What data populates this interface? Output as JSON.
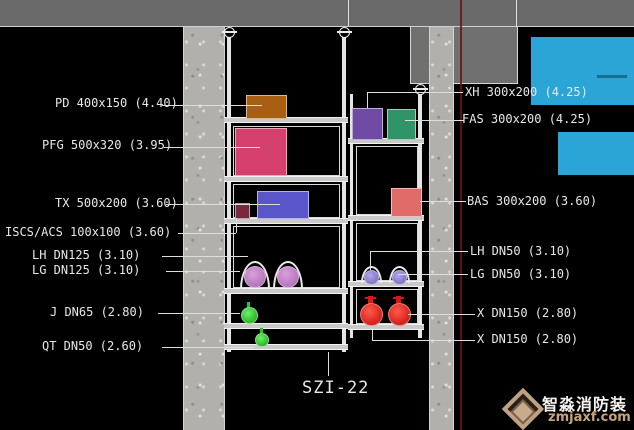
{
  "section_label": "SZI-22",
  "labels_left": [
    {
      "text": "PD 400x150 (4.40)"
    },
    {
      "text": "PFG 500x320 (3.95)"
    },
    {
      "text": "TX 500x200 (3.60)"
    },
    {
      "text": "ISCS/ACS 100x100 (3.60)"
    },
    {
      "text": "LH DN125 (3.10)"
    },
    {
      "text": "LG DN125 (3.10)"
    },
    {
      "text": "J DN65 (2.80)"
    },
    {
      "text": "QT DN50 (2.60)"
    }
  ],
  "labels_right": [
    {
      "text": "XH 300x200 (4.25)"
    },
    {
      "text": "FAS 300x200 (4.25)"
    },
    {
      "text": "BAS 300x200 (3.60)"
    },
    {
      "text": "LH DN50 (3.10)"
    },
    {
      "text": "LG DN50 (3.10)"
    },
    {
      "text": "X DN150 (2.80)"
    },
    {
      "text": "X DN150 (2.80)"
    }
  ],
  "watermark": {
    "brand": "智淼消防装",
    "url": "zmjaxf.com"
  },
  "colors": {
    "background": "#000000",
    "concrete_slab": "#6a6a6a",
    "concrete_wall": "#b2b0ad",
    "duct_pd_orange": "#a95f12",
    "duct_pfg_pink": "#d5406e",
    "duct_tx_blue": "#5a55c8",
    "duct_iscs_maroon": "#79293c",
    "duct_xh_purple": "#6f4aa2",
    "duct_fas_green": "#2f9468",
    "duct_bas_salmon": "#e06c69",
    "pipe_dn125_pink": "#bd7ec4",
    "pipe_dn50_purple": "#8d7fd2",
    "pipe_green": "#1ecb1e",
    "pipe_red": "#e11414",
    "highlight_cyan": "#2ba4d6",
    "marker_red_line": "#6e1212",
    "frame_white": "#e4e4e4"
  }
}
